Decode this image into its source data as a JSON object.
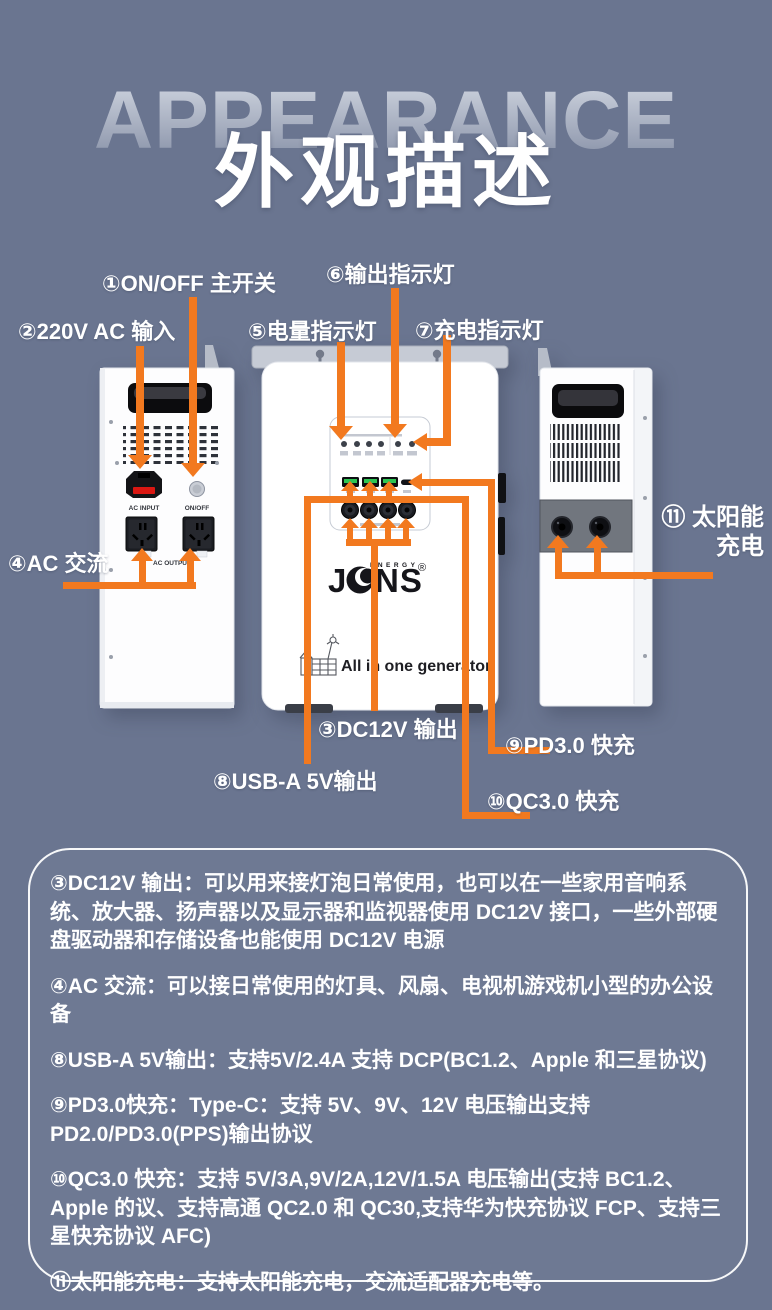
{
  "colors": {
    "background": "#6A7590",
    "accent_orange": "#F2791F",
    "panel_border": "#FFFFFF",
    "text": "#FFFFFF"
  },
  "header": {
    "watermark": "APPEARANCE",
    "title": "外观描述"
  },
  "callouts": {
    "c1": "①ON/OFF 主开关",
    "c2": "②220V AC 输入",
    "c3": "③DC12V 输出",
    "c4": "④AC 交流",
    "c5": "⑤电量指示灯",
    "c6": "⑥输出指示灯",
    "c7": "⑦充电指示灯",
    "c8": "⑧USB-A 5V输出",
    "c9": "⑨PD3.0 快充",
    "c10": "⑩QC3.0 快充",
    "c11_line1": "⑪ 太阳能",
    "c11_line2": "充电"
  },
  "device": {
    "ac_input_label": "AC INPUT",
    "onoff_label": "ON/OFF",
    "ac_output_label": "AC OUTPUT",
    "logo_j": "J",
    "logo_ns": "NS",
    "logo_energy": "ENERGY",
    "logo_reg": "®",
    "tagline": "All in one generator"
  },
  "info_panel": {
    "paragraphs": [
      "③DC12V 输出：可以用来接灯泡日常使用，也可以在一些家用音响系统、放大器、扬声器以及显示器和监视器使用 DC12V 接口，一些外部硬盘驱动器和存储设备也能使用 DC12V 电源",
      "④AC 交流：可以接日常使用的灯具、风扇、电视机游戏机小型的办公设备",
      "⑧USB-A 5V输出：支持5V/2.4A 支持 DCP(BC1.2、Apple 和三星协议)",
      "⑨PD3.0快充：Type-C：支持 5V、9V、12V 电压输出支持 PD2.0/PD3.0(PPS)输出协议",
      "⑩QC3.0 快充：支持 5V/3A,9V/2A,12V/1.5A 电压输出(支持 BC1.2、Apple 的议、支持高通 QC2.0 和 QC30,支持华为快充协议 FCP、支持三星快充协议 AFC)",
      "⑪太阳能充电：支持太阳能充电，交流适配器充电等。"
    ]
  }
}
